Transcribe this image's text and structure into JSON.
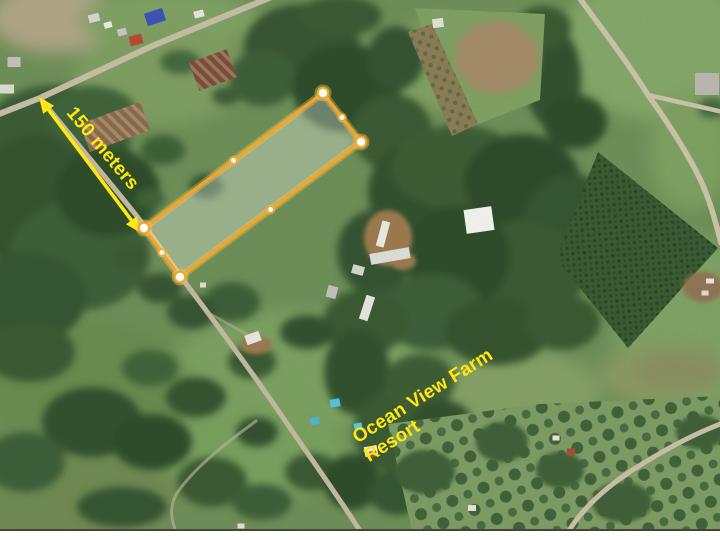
{
  "window": {
    "background": "#FFFFFF"
  },
  "map": {
    "frame_border_color": "#44443C"
  },
  "overlay": {
    "colors": {
      "parcel_stroke": "#EFA62F",
      "parcel_fill": "rgba(255,255,255,0.30)",
      "parcel_glow": "rgba(255,195,80,0.38)",
      "handle_fill": "#FFFEF6",
      "handle_glow": "rgba(255,195,80,0.42)",
      "arrow": "#FFE712",
      "label_text": "#FFE712"
    },
    "parcel": {
      "corners": [
        [
          323,
          93
        ],
        [
          361,
          142
        ],
        [
          180,
          277
        ],
        [
          144,
          228
        ]
      ],
      "midpoints": [
        [
          342,
          117.5
        ],
        [
          270.5,
          209.5
        ],
        [
          162,
          252.5
        ],
        [
          233.5,
          160.5
        ]
      ]
    },
    "measurement": {
      "label": "150 meters",
      "arrow_from": [
        39,
        97
      ],
      "arrow_to": [
        141,
        233
      ],
      "label_pos": [
        78,
        103
      ],
      "label_rotation_deg": 50
    },
    "resort_label": {
      "line1": "Ocean View Farm",
      "line2": "Resort",
      "pos": [
        349,
        430
      ],
      "rotation_deg": -32
    }
  }
}
